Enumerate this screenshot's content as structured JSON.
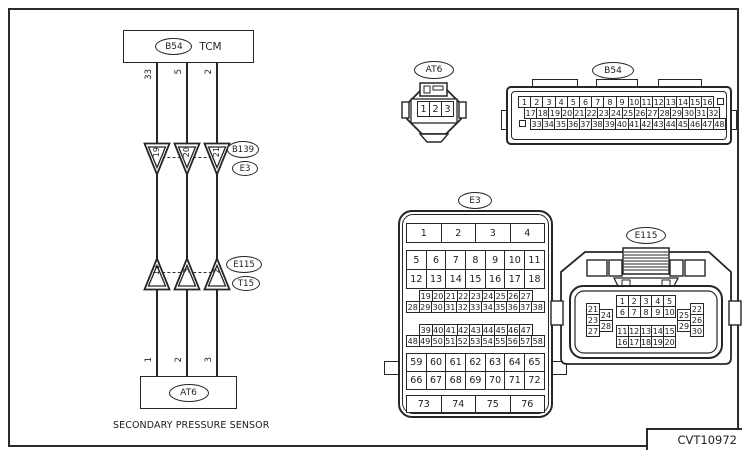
{
  "frame": {
    "code": "CVT10972"
  },
  "schematic": {
    "tcm_box": {
      "connector": "B54",
      "label": "TCM"
    },
    "junction1": {
      "labels": [
        "B139",
        "E3"
      ]
    },
    "junction2": {
      "labels": [
        "E115",
        "T15"
      ]
    },
    "sensor_box": {
      "connector": "AT6",
      "caption": "SECONDARY PRESSURE SENSOR"
    },
    "wires": [
      {
        "tcm_pin": "33",
        "j1_pin": "19",
        "j2_pin": "12",
        "sensor_pin": "1"
      },
      {
        "tcm_pin": "5",
        "j1_pin": "20",
        "j2_pin": "3",
        "sensor_pin": "2"
      },
      {
        "tcm_pin": "2",
        "j1_pin": "21",
        "j2_pin": "2",
        "sensor_pin": "3"
      }
    ]
  },
  "connectors": {
    "at6": {
      "label": "AT6",
      "pins": [
        "1",
        "2",
        "3"
      ]
    },
    "b54": {
      "label": "B54",
      "row1": [
        "1",
        "2",
        "3",
        "4",
        "5",
        "6",
        "7",
        "8",
        "9",
        "10",
        "11",
        "12",
        "13",
        "14",
        "15",
        "16"
      ],
      "row2": [
        "17",
        "18",
        "19",
        "20",
        "21",
        "22",
        "23",
        "24",
        "25",
        "26",
        "27",
        "28",
        "29",
        "30",
        "31",
        "32"
      ],
      "row3": [
        "33",
        "34",
        "35",
        "36",
        "37",
        "38",
        "39",
        "40",
        "41",
        "42",
        "43",
        "44",
        "45",
        "46",
        "47",
        "48"
      ]
    },
    "e3": {
      "label": "E3",
      "row_a": [
        "1",
        "2",
        "3",
        "4"
      ],
      "row_b": [
        "5",
        "6",
        "7",
        "8",
        "9",
        "10",
        "11"
      ],
      "row_c": [
        "12",
        "13",
        "14",
        "15",
        "16",
        "17",
        "18"
      ],
      "row_d": [
        "19",
        "20",
        "21",
        "22",
        "23",
        "24",
        "25",
        "26",
        "27"
      ],
      "row_e": [
        "28",
        "29",
        "30",
        "31",
        "32",
        "33",
        "34",
        "35",
        "36",
        "37",
        "38"
      ],
      "row_f": [
        "39",
        "40",
        "41",
        "42",
        "43",
        "44",
        "45",
        "46",
        "47"
      ],
      "row_g": [
        "48",
        "49",
        "50",
        "51",
        "52",
        "53",
        "54",
        "55",
        "56",
        "57",
        "58"
      ],
      "row_h": [
        "59",
        "60",
        "61",
        "62",
        "63",
        "64",
        "65"
      ],
      "row_i": [
        "66",
        "67",
        "68",
        "69",
        "70",
        "71",
        "72"
      ],
      "row_j": [
        "73",
        "74",
        "75",
        "76"
      ]
    },
    "e115": {
      "label": "E115",
      "center_top_row1": [
        "1",
        "2",
        "3",
        "4",
        "5"
      ],
      "center_top_row2": [
        "6",
        "7",
        "8",
        "9",
        "10"
      ],
      "center_bottom_row1": [
        "11",
        "12",
        "13",
        "14",
        "15"
      ],
      "center_bottom_row2": [
        "16",
        "17",
        "18",
        "19",
        "20"
      ],
      "left_col_outer": [
        "21",
        "23",
        "27"
      ],
      "left_col_inner": [
        "24",
        "28"
      ],
      "right_col_inner": [
        "25",
        "29"
      ],
      "right_col_outer": [
        "22",
        "26",
        "30"
      ]
    }
  }
}
